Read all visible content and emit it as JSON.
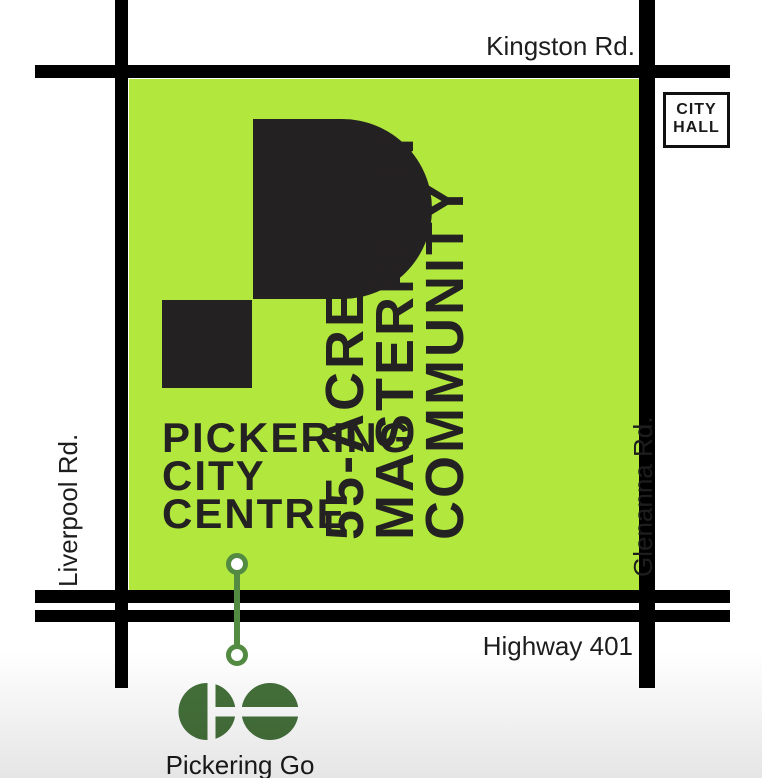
{
  "map": {
    "parcel": {
      "name_lines": [
        "PICKERING",
        "CITY",
        "CENTRE"
      ],
      "tagline_lines": [
        "55-ACRE",
        "MASTERPLAN",
        "COMMUNITY"
      ]
    },
    "roads": {
      "north": "Kingston Rd.",
      "south": "Highway 401",
      "west": "Liverpool Rd.",
      "east": "Glenanna Rd."
    },
    "city_hall": {
      "lines": [
        "CITY",
        "HALL"
      ]
    },
    "transit": {
      "station": "Pickering Go",
      "logo": "go-transit-logo"
    },
    "colors": {
      "lime": "#b2e83d",
      "ink": "#242122",
      "road": "#000000",
      "go_green": "#44703a",
      "connector_green": "#538b42"
    }
  }
}
